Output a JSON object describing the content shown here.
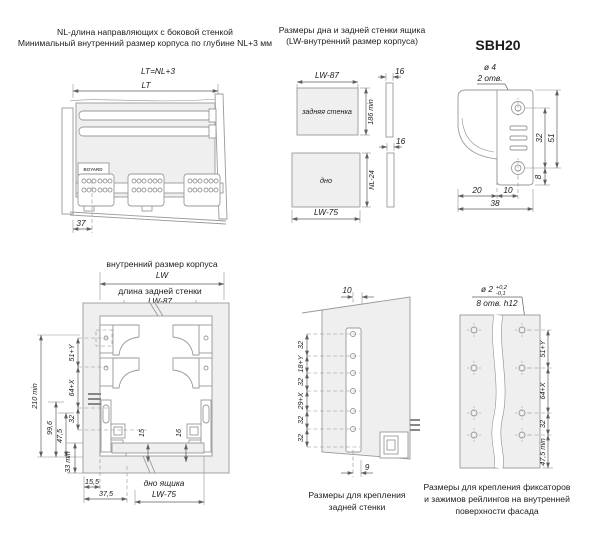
{
  "colors": {
    "background": "#ffffff",
    "outline": "#9a9a9a",
    "dimension": "#5f5f5f",
    "panel_fill": "#efefef",
    "text": "#1c1c1c"
  },
  "top_left": {
    "caption1": "NL-длина направляющих с боковой стенкой",
    "caption2": "Минимальный внутренний размер корпуса по глубине NL+3 мм",
    "formula": "LT=NL+3",
    "dim_lt": "LT",
    "dim_37": "37",
    "logo": "BOYARD"
  },
  "top_middle": {
    "caption1": "Размеры дна и задней стенки ящика",
    "caption2": "(LW-внутренний размер корпуса)",
    "back_panel": {
      "label": "задняя стенка",
      "width": "LW-87",
      "height": "186 min",
      "thickness": "16"
    },
    "bottom_panel": {
      "label": "дно",
      "width": "LW-75",
      "height": "NL-24",
      "thickness": "16"
    }
  },
  "top_right": {
    "title": "SBH20",
    "hole_dia": "ø 4",
    "hole_count": "2 отв.",
    "dim_32": "32",
    "dim_51": "51",
    "dim_8": "8",
    "dim_20": "20",
    "dim_10": "10",
    "dim_38": "38"
  },
  "bottom_left": {
    "caption_lw": "внутренний размер корпуса",
    "dim_lw": "LW",
    "caption_back": "длина задней стенки",
    "dim_lw87": "LW-87",
    "dim_210": "210 min",
    "dim_996": "99,6",
    "dim_475": "47,5",
    "dim_33": "33 min",
    "chain_51y": "51+Y",
    "chain_64x": "64+X",
    "chain_32": "32",
    "dim_155": "15,5",
    "dim_375": "37,5",
    "gap_15": "15",
    "gap_16": "16",
    "caption_dno": "дно ящика",
    "dim_lw75": "LW-75"
  },
  "bottom_middle": {
    "dim_10": "10",
    "chain": [
      "32",
      "18+Y",
      "32",
      "29+X",
      "32",
      "32"
    ],
    "dim_9": "9",
    "caption1": "Размеры для крепления",
    "caption2": "задней стенки"
  },
  "bottom_right": {
    "hole_dia": "ø 2",
    "tol_plus": "+0,2",
    "tol_minus": "-0,1",
    "hole_count": "8 отв. h12",
    "chain": [
      "51+Y",
      "64+X",
      "32",
      "47,5 min"
    ],
    "caption1": "Размеры для крепления фиксаторов",
    "caption2": "и зажимов рейлингов на внутренней",
    "caption3": "поверхности фасада"
  }
}
